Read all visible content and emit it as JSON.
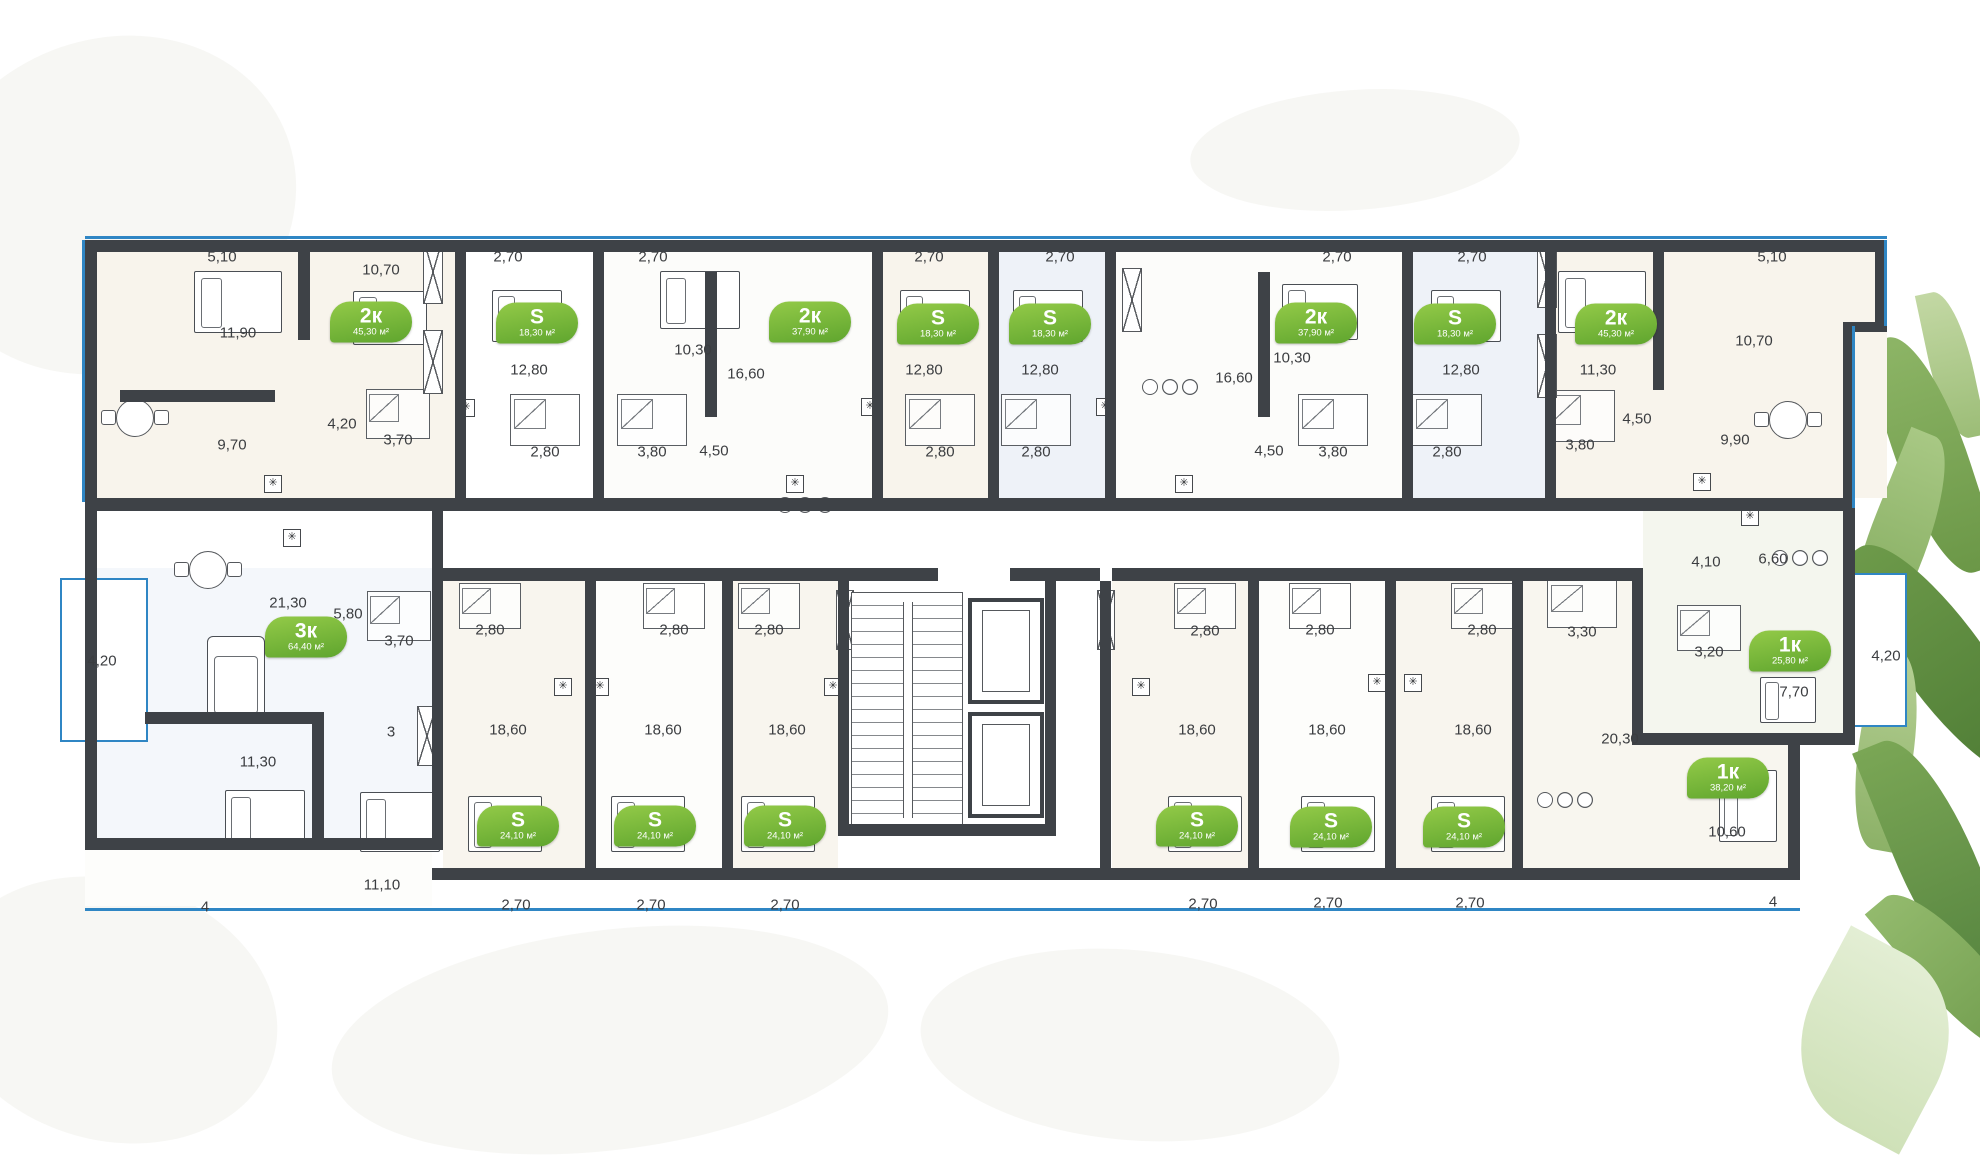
{
  "palette": {
    "wall": "#3e4247",
    "window_blue": "#2f86c4",
    "badge_green_light": "#93ca48",
    "badge_green_dark": "#5fa52e",
    "dim_text": "#3b3d40"
  },
  "badges": [
    {
      "label": "2к",
      "area": "45,30 м²",
      "x": 371,
      "y": 322
    },
    {
      "label": "S",
      "area": "18,30 м²",
      "x": 537,
      "y": 323
    },
    {
      "label": "2к",
      "area": "37,90 м²",
      "x": 810,
      "y": 322
    },
    {
      "label": "S",
      "area": "18,30 м²",
      "x": 938,
      "y": 324
    },
    {
      "label": "S",
      "area": "18,30 м²",
      "x": 1050,
      "y": 324
    },
    {
      "label": "2к",
      "area": "37,90 м²",
      "x": 1316,
      "y": 323
    },
    {
      "label": "S",
      "area": "18,30 м²",
      "x": 1455,
      "y": 324
    },
    {
      "label": "2к",
      "area": "45,30 м²",
      "x": 1616,
      "y": 324
    },
    {
      "label": "3к",
      "area": "64,40 м²",
      "x": 306,
      "y": 637
    },
    {
      "label": "S",
      "area": "24,10 м²",
      "x": 518,
      "y": 826
    },
    {
      "label": "S",
      "area": "24,10 м²",
      "x": 655,
      "y": 826
    },
    {
      "label": "S",
      "area": "24,10 м²",
      "x": 785,
      "y": 826
    },
    {
      "label": "S",
      "area": "24,10 м²",
      "x": 1197,
      "y": 826
    },
    {
      "label": "S",
      "area": "24,10 м²",
      "x": 1331,
      "y": 827
    },
    {
      "label": "S",
      "area": "24,10 м²",
      "x": 1464,
      "y": 827
    },
    {
      "label": "1к",
      "area": "25,80 м²",
      "x": 1790,
      "y": 651
    },
    {
      "label": "1к",
      "area": "38,20 м²",
      "x": 1728,
      "y": 778
    }
  ],
  "dims": [
    {
      "t": "5,10",
      "x": 222,
      "y": 257
    },
    {
      "t": "2,70",
      "x": 508,
      "y": 257
    },
    {
      "t": "2,70",
      "x": 653,
      "y": 257
    },
    {
      "t": "2,70",
      "x": 929,
      "y": 257
    },
    {
      "t": "2,70",
      "x": 1060,
      "y": 257
    },
    {
      "t": "2,70",
      "x": 1337,
      "y": 257
    },
    {
      "t": "2,70",
      "x": 1472,
      "y": 257
    },
    {
      "t": "5,10",
      "x": 1772,
      "y": 257
    },
    {
      "t": "10,70",
      "x": 381,
      "y": 270
    },
    {
      "t": "11,90",
      "x": 238,
      "y": 333
    },
    {
      "t": "12,80",
      "x": 529,
      "y": 370
    },
    {
      "t": "10,30",
      "x": 693,
      "y": 350
    },
    {
      "t": "16,60",
      "x": 746,
      "y": 374
    },
    {
      "t": "12,80",
      "x": 924,
      "y": 370
    },
    {
      "t": "12,80",
      "x": 1040,
      "y": 370
    },
    {
      "t": "16,60",
      "x": 1234,
      "y": 378
    },
    {
      "t": "10,30",
      "x": 1292,
      "y": 358
    },
    {
      "t": "12,80",
      "x": 1461,
      "y": 370
    },
    {
      "t": "11,30",
      "x": 1598,
      "y": 370
    },
    {
      "t": "10,70",
      "x": 1754,
      "y": 341
    },
    {
      "t": "4,20",
      "x": 342,
      "y": 424
    },
    {
      "t": "3,70",
      "x": 398,
      "y": 440
    },
    {
      "t": "9,70",
      "x": 232,
      "y": 445
    },
    {
      "t": "2,80",
      "x": 545,
      "y": 452
    },
    {
      "t": "3,80",
      "x": 652,
      "y": 452
    },
    {
      "t": "4,50",
      "x": 714,
      "y": 451
    },
    {
      "t": "2,80",
      "x": 940,
      "y": 452
    },
    {
      "t": "2,80",
      "x": 1036,
      "y": 452
    },
    {
      "t": "4,50",
      "x": 1269,
      "y": 451
    },
    {
      "t": "3,80",
      "x": 1333,
      "y": 452
    },
    {
      "t": "2,80",
      "x": 1447,
      "y": 452
    },
    {
      "t": "3,80",
      "x": 1580,
      "y": 445
    },
    {
      "t": "4,50",
      "x": 1637,
      "y": 419
    },
    {
      "t": "9,90",
      "x": 1735,
      "y": 440
    },
    {
      "t": "4,10",
      "x": 1706,
      "y": 562
    },
    {
      "t": "6,60",
      "x": 1773,
      "y": 559
    },
    {
      "t": "21,30",
      "x": 288,
      "y": 603
    },
    {
      "t": "5,80",
      "x": 348,
      "y": 614
    },
    {
      "t": "4,20",
      "x": 102,
      "y": 661
    },
    {
      "t": "3,70",
      "x": 399,
      "y": 641
    },
    {
      "t": "11,30",
      "x": 258,
      "y": 762
    },
    {
      "t": "11,10",
      "x": 382,
      "y": 885
    },
    {
      "t": "4",
      "x": 205,
      "y": 907
    },
    {
      "t": "3",
      "x": 391,
      "y": 732
    },
    {
      "t": "2,80",
      "x": 490,
      "y": 630
    },
    {
      "t": "2,80",
      "x": 674,
      "y": 630
    },
    {
      "t": "2,80",
      "x": 769,
      "y": 630
    },
    {
      "t": "18,60",
      "x": 508,
      "y": 730
    },
    {
      "t": "18,60",
      "x": 663,
      "y": 730
    },
    {
      "t": "18,60",
      "x": 787,
      "y": 730
    },
    {
      "t": "2,70",
      "x": 516,
      "y": 905
    },
    {
      "t": "2,70",
      "x": 651,
      "y": 905
    },
    {
      "t": "2,70",
      "x": 785,
      "y": 905
    },
    {
      "t": "2,80",
      "x": 1205,
      "y": 631
    },
    {
      "t": "2,80",
      "x": 1320,
      "y": 630
    },
    {
      "t": "2,80",
      "x": 1482,
      "y": 630
    },
    {
      "t": "18,60",
      "x": 1197,
      "y": 730
    },
    {
      "t": "18,60",
      "x": 1327,
      "y": 730
    },
    {
      "t": "18,60",
      "x": 1473,
      "y": 730
    },
    {
      "t": "2,70",
      "x": 1203,
      "y": 904
    },
    {
      "t": "2,70",
      "x": 1328,
      "y": 903
    },
    {
      "t": "2,70",
      "x": 1470,
      "y": 903
    },
    {
      "t": "3,30",
      "x": 1582,
      "y": 632
    },
    {
      "t": "3,20",
      "x": 1709,
      "y": 652
    },
    {
      "t": "20,30",
      "x": 1620,
      "y": 739
    },
    {
      "t": "7,70",
      "x": 1794,
      "y": 692
    },
    {
      "t": "4,20",
      "x": 1886,
      "y": 656
    },
    {
      "t": "10,60",
      "x": 1727,
      "y": 832
    },
    {
      "t": "4",
      "x": 1773,
      "y": 902
    }
  ],
  "vents": [
    {
      "x": 466,
      "y": 408
    },
    {
      "x": 870,
      "y": 407
    },
    {
      "x": 795,
      "y": 484
    },
    {
      "x": 1105,
      "y": 407
    },
    {
      "x": 1184,
      "y": 484
    },
    {
      "x": 273,
      "y": 484
    },
    {
      "x": 292,
      "y": 538
    },
    {
      "x": 563,
      "y": 687
    },
    {
      "x": 600,
      "y": 687
    },
    {
      "x": 833,
      "y": 687
    },
    {
      "x": 1141,
      "y": 687
    },
    {
      "x": 1377,
      "y": 683
    },
    {
      "x": 1413,
      "y": 683
    },
    {
      "x": 1702,
      "y": 482
    },
    {
      "x": 1750,
      "y": 517
    }
  ],
  "wardrobes": [
    {
      "x": 433,
      "y": 272,
      "w": 20,
      "h": 64
    },
    {
      "x": 433,
      "y": 362,
      "w": 20,
      "h": 64
    },
    {
      "x": 1132,
      "y": 300,
      "w": 20,
      "h": 64
    },
    {
      "x": 1547,
      "y": 276,
      "w": 20,
      "h": 64
    },
    {
      "x": 1547,
      "y": 366,
      "w": 20,
      "h": 64
    },
    {
      "x": 845,
      "y": 620,
      "w": 18,
      "h": 60
    },
    {
      "x": 1106,
      "y": 620,
      "w": 18,
      "h": 60
    },
    {
      "x": 427,
      "y": 736,
      "w": 20,
      "h": 60
    }
  ],
  "beds": [
    {
      "x": 238,
      "y": 302,
      "w": 88,
      "h": 62
    },
    {
      "x": 390,
      "y": 318,
      "w": 74,
      "h": 54
    },
    {
      "x": 527,
      "y": 316,
      "w": 70,
      "h": 52
    },
    {
      "x": 700,
      "y": 300,
      "w": 80,
      "h": 58
    },
    {
      "x": 935,
      "y": 316,
      "w": 70,
      "h": 52
    },
    {
      "x": 1048,
      "y": 316,
      "w": 70,
      "h": 52
    },
    {
      "x": 1320,
      "y": 312,
      "w": 76,
      "h": 56
    },
    {
      "x": 1466,
      "y": 316,
      "w": 70,
      "h": 52
    },
    {
      "x": 1602,
      "y": 302,
      "w": 88,
      "h": 62
    },
    {
      "x": 265,
      "y": 820,
      "w": 80,
      "h": 60
    },
    {
      "x": 400,
      "y": 822,
      "w": 80,
      "h": 60
    },
    {
      "x": 505,
      "y": 824,
      "w": 74,
      "h": 56
    },
    {
      "x": 648,
      "y": 824,
      "w": 74,
      "h": 56
    },
    {
      "x": 778,
      "y": 824,
      "w": 74,
      "h": 56
    },
    {
      "x": 1205,
      "y": 824,
      "w": 74,
      "h": 56
    },
    {
      "x": 1338,
      "y": 824,
      "w": 74,
      "h": 56
    },
    {
      "x": 1468,
      "y": 824,
      "w": 74,
      "h": 56
    },
    {
      "x": 1748,
      "y": 806,
      "w": 58,
      "h": 72
    },
    {
      "x": 1788,
      "y": 700,
      "w": 56,
      "h": 46
    }
  ],
  "baths": [
    {
      "x": 398,
      "y": 414,
      "w": 64,
      "h": 50
    },
    {
      "x": 545,
      "y": 420,
      "w": 70,
      "h": 52
    },
    {
      "x": 652,
      "y": 420,
      "w": 70,
      "h": 52
    },
    {
      "x": 940,
      "y": 420,
      "w": 70,
      "h": 52
    },
    {
      "x": 1036,
      "y": 420,
      "w": 70,
      "h": 52
    },
    {
      "x": 1333,
      "y": 420,
      "w": 70,
      "h": 52
    },
    {
      "x": 1447,
      "y": 420,
      "w": 70,
      "h": 52
    },
    {
      "x": 1580,
      "y": 416,
      "w": 70,
      "h": 52
    },
    {
      "x": 399,
      "y": 616,
      "w": 64,
      "h": 50
    },
    {
      "x": 490,
      "y": 606,
      "w": 62,
      "h": 46
    },
    {
      "x": 674,
      "y": 606,
      "w": 62,
      "h": 46
    },
    {
      "x": 769,
      "y": 606,
      "w": 62,
      "h": 46
    },
    {
      "x": 1205,
      "y": 606,
      "w": 62,
      "h": 46
    },
    {
      "x": 1320,
      "y": 606,
      "w": 62,
      "h": 46
    },
    {
      "x": 1482,
      "y": 606,
      "w": 62,
      "h": 46
    },
    {
      "x": 1582,
      "y": 604,
      "w": 70,
      "h": 48
    },
    {
      "x": 1709,
      "y": 628,
      "w": 64,
      "h": 46
    }
  ],
  "tables": [
    {
      "x": 135,
      "y": 418,
      "kind": "table"
    },
    {
      "x": 208,
      "y": 570,
      "kind": "table"
    },
    {
      "x": 1788,
      "y": 420,
      "kind": "table"
    },
    {
      "x": 805,
      "y": 505,
      "kind": "stools"
    },
    {
      "x": 1170,
      "y": 387,
      "kind": "stools"
    },
    {
      "x": 1565,
      "y": 800,
      "kind": "stools"
    },
    {
      "x": 1800,
      "y": 558,
      "kind": "stools"
    }
  ],
  "sofas": [
    {
      "x": 236,
      "y": 680,
      "w": 58,
      "h": 88
    }
  ]
}
